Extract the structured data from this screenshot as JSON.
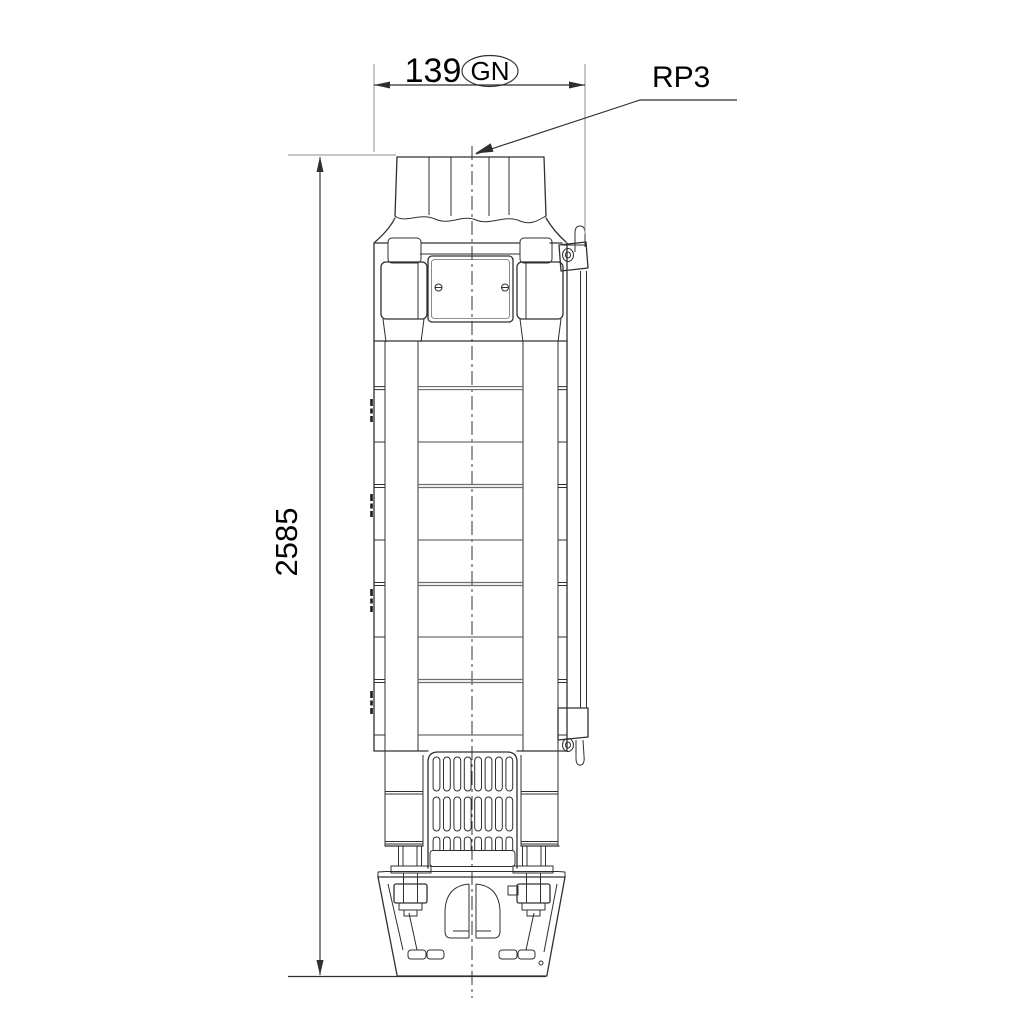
{
  "colors": {
    "background": "#ffffff",
    "line": "#303030",
    "dim": "#2f2f2f",
    "ext": "#8f8f8f",
    "stage": "#6e6e6e",
    "text": "#000000"
  },
  "annotations": {
    "width_dimension": {
      "value": "139",
      "thread_badge": "GN"
    },
    "length_dimension": {
      "value": "2585"
    },
    "connection_label": "RP3"
  }
}
